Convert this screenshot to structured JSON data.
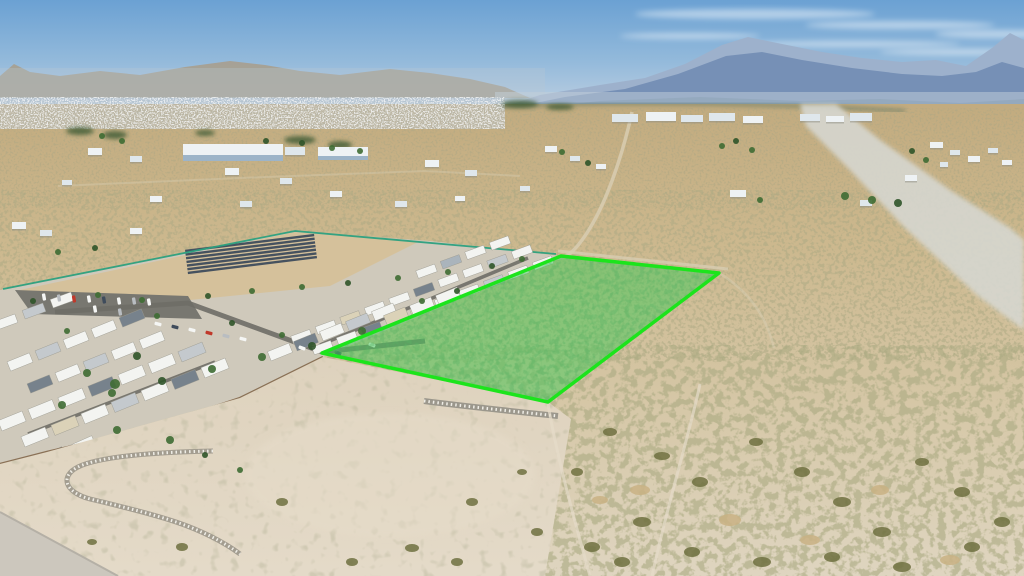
{
  "scene_meta": {
    "type": "aerial-drone-photo",
    "description": "Aerial photo of a desert valley: a vacant land parcel outlined and shaded in bright green, bordered by a mobile home park on the left, open desert scrub on the right, distant town and blue mountain ranges at the horizon."
  },
  "colors": {
    "sky_top": "#6ba1d3",
    "sky_mid": "#94badb",
    "sky_low": "#b5cbe0",
    "sky_horizon": "#ccd9e4",
    "cloud": "#ffffff",
    "left_hills": "#a79e8e",
    "haze_left": "#b9c6d2",
    "mtn_far": "#9db1cc",
    "mtn_main": "#7690b6",
    "mtn_foot": "#62809f",
    "haze_right": "#c3d0da",
    "valley_green": "#56715f",
    "desert_far": "#c2ab7f",
    "desert_mid": "#ccb88e",
    "desert_near": "#d7c9aa",
    "desert_bottom": "#dfd5c0",
    "wash": "#d7d8d2",
    "town_base": "#b6bfc6",
    "road_dirt": "#d8cdb2",
    "bldg_A": "#eef2f4",
    "bldg_B": "#dfe7ec",
    "bldg_C": "#9db4c8",
    "bldg_shadow": "#8d8d84",
    "park_base": "#cfc9bb",
    "dirt_lot": "#d5c19b",
    "parking": "#787770",
    "park_road": "#6f6e67",
    "solar": "#46525f",
    "fence_teal": "#2ba07e",
    "wall_brown": "#8a7156",
    "home_w": "#f3f4f1",
    "home_g": "#c4c9cd",
    "home_d": "#77828c",
    "home_t": "#dbd2b8",
    "home_b": "#aab4bc",
    "car_w": "#f5f6f4",
    "car_s": "#b9bdc1",
    "car_r": "#c0392b",
    "car_d": "#3f4c5c",
    "tree": "#3e6b33",
    "tree_dark": "#2f5429",
    "grove": "#3f5a33",
    "pad_light": "#e6dcc9",
    "pad_base1": "#ded2bd",
    "pad_base2": "#e4dac8",
    "berm": "#a39d90",
    "berm_rocks": "#efede6",
    "rock_strip": "#9b978c",
    "wedge": "#ccc7bd",
    "wedge_edge": "#b5b0a6",
    "shrub": "#6f7040",
    "grass": "#c9b184",
    "parcel_fill": "#46c95a",
    "parcel_stroke": "#1ce41c"
  },
  "parcel": {
    "points": "561,256 719,273 548,402 322,353"
  },
  "paths": {
    "left_hills": "M0,98 L0,76 L14,64 L30,72 L60,76 L100,71 L140,75 L185,67 L230,61 L265,65 L300,71 L340,75 L390,69 L430,73 L470,79 L505,87 L530,98 Z",
    "mtn_far": "M500,108 L540,95 L600,85 L645,78 L685,64 L722,45 L748,37 L782,44 L822,52 L862,58 L902,62 L936,60 L966,66 L992,48 L1010,33 L1024,40 L1024,108 Z",
    "mtn_main": "M510,108 L565,97 L625,89 L678,74 L726,56 L762,52 L802,60 L852,68 L902,74 L942,76 L976,72 L1002,62 L1024,68 L1024,108 Z",
    "mtn_foot": "M495,112 L600,101 L700,97 L800,101 L880,99 L960,103 L1024,99 L1024,120 L495,120 Z",
    "valley_green": "M495,106 Q700,99 905,111",
    "wash": "M800,104 L836,104 L880,140 L950,190 L1010,228 L1024,240 L1024,330 L978,296 L905,228 L848,168 L806,126 Z",
    "road_main": "M632,112 C622,158 606,202 590,228 C578,248 566,260 556,258",
    "road_ne": "M558,251 L728,269",
    "road_corner": "M719,273 C747,290 766,314 774,348",
    "road_left": "M58,186 L240,178 L425,171 L520,176",
    "fence_teal": "M3,289 L295,231 L556,254",
    "wall": "M323,357 L240,398 L150,428 L47,452 L0,464",
    "park_base": "M0,290 L295,231 L430,241 L561,256 L323,357 L240,398 L47,452 L0,464 Z",
    "dirt_lot": "M15,291 L295,232 L420,241 L330,286 L160,303 Z",
    "parking": "M15,290 L188,296 L202,319 L32,314 Z",
    "street1": "M55,312 L188,303 L322,352 L425,341",
    "street2": "M528,258 L320,345",
    "street3": "M215,362 L28,434",
    "pad": "M0,464 L47,452 L240,398 L323,357 L548,402 L571,419 L545,576 L0,576 Z",
    "rock_loop": "M213,451 C160,452 100,456 78,467 C60,476 64,492 90,499 C124,507 152,514 176,522 C200,530 224,542 240,554",
    "rock_strip": "M424,401 C462,406 510,411 558,416",
    "track1": "M700,384 C690,432 668,502 652,576",
    "track2": "M548,404 C556,452 572,512 590,576",
    "wedge": "M0,512 L118,576 L0,576 Z",
    "wedge_edge": "M0,512 L118,576"
  },
  "solar_array": {
    "x0": 186,
    "x1": 316,
    "y": 243,
    "dy": 3.7,
    "n": 7,
    "rot": -7,
    "cx": 250,
    "cy": 254
  },
  "scene": {
    "clouds": [
      [
        755,
        14,
        120,
        5
      ],
      [
        900,
        25,
        95,
        4
      ],
      [
        1000,
        34,
        65,
        4
      ],
      [
        690,
        36,
        70,
        3
      ],
      [
        850,
        44,
        110,
        3
      ],
      [
        960,
        52,
        80,
        3
      ]
    ],
    "buildings": [
      [
        183,
        144,
        100,
        12,
        "A"
      ],
      [
        183,
        155,
        100,
        6,
        "C"
      ],
      [
        285,
        147,
        20,
        8,
        "B"
      ],
      [
        318,
        147,
        50,
        10,
        "A"
      ],
      [
        318,
        156,
        50,
        4,
        "C"
      ],
      [
        612,
        114,
        26,
        8,
        "B"
      ],
      [
        646,
        112,
        30,
        9,
        "A"
      ],
      [
        681,
        115,
        22,
        7,
        "B"
      ],
      [
        709,
        113,
        26,
        8,
        "B"
      ],
      [
        743,
        116,
        20,
        7,
        "A"
      ],
      [
        800,
        114,
        20,
        7,
        "B"
      ],
      [
        826,
        116,
        18,
        6,
        "A"
      ],
      [
        850,
        113,
        22,
        8,
        "B"
      ],
      [
        930,
        142,
        13,
        6,
        "A"
      ],
      [
        950,
        150,
        10,
        5,
        "B"
      ],
      [
        968,
        156,
        12,
        6,
        "A"
      ],
      [
        988,
        148,
        10,
        5,
        "B"
      ],
      [
        1002,
        160,
        10,
        5,
        "A"
      ],
      [
        940,
        162,
        8,
        5,
        "B"
      ],
      [
        88,
        148,
        14,
        7,
        "A"
      ],
      [
        130,
        156,
        12,
        6,
        "B"
      ],
      [
        225,
        168,
        14,
        7,
        "A"
      ],
      [
        280,
        178,
        12,
        6,
        "B"
      ],
      [
        425,
        160,
        14,
        7,
        "A"
      ],
      [
        465,
        170,
        12,
        6,
        "B"
      ],
      [
        545,
        146,
        12,
        6,
        "A"
      ],
      [
        570,
        156,
        10,
        5,
        "B"
      ],
      [
        596,
        164,
        10,
        5,
        "A"
      ],
      [
        62,
        180,
        10,
        5,
        "B"
      ],
      [
        150,
        196,
        12,
        6,
        "A"
      ],
      [
        240,
        201,
        12,
        6,
        "B"
      ],
      [
        330,
        191,
        12,
        6,
        "A"
      ],
      [
        395,
        201,
        12,
        6,
        "B"
      ],
      [
        455,
        196,
        10,
        5,
        "A"
      ],
      [
        520,
        186,
        10,
        5,
        "B"
      ],
      [
        12,
        222,
        14,
        7,
        "A"
      ],
      [
        40,
        230,
        12,
        6,
        "B"
      ],
      [
        130,
        228,
        12,
        6,
        "A"
      ],
      [
        730,
        190,
        16,
        7,
        "A"
      ],
      [
        860,
        200,
        12,
        6,
        "B"
      ],
      [
        905,
        175,
        12,
        6,
        "A"
      ]
    ],
    "homes_rows": [
      {
        "x": 543,
        "y": 263,
        "n": 10,
        "dx": -24.5,
        "dy": 9.4,
        "w": 20,
        "h": 8,
        "r": -20,
        "cs": "wwgwwtwdww"
      },
      {
        "x": 522,
        "y": 252,
        "n": 10,
        "dx": -24.5,
        "dy": 9.4,
        "w": 20,
        "h": 8,
        "r": -20,
        "cs": "wgwwdwwtww"
      },
      {
        "x": 500,
        "y": 243,
        "n": 4,
        "dx": -24.5,
        "dy": 9.4,
        "w": 20,
        "h": 8,
        "r": -20,
        "cs": "wwbw"
      },
      {
        "x": 384,
        "y": 312,
        "n": 5,
        "dx": -26,
        "dy": 10,
        "w": 23,
        "h": 10,
        "r": -22,
        "cs": "wgwdw"
      },
      {
        "x": 448,
        "y": 296,
        "n": 3,
        "dx": -26,
        "dy": 10,
        "w": 23,
        "h": 10,
        "r": -22,
        "cs": "wwt"
      },
      {
        "x": 215,
        "y": 368,
        "n": 7,
        "dx": -30,
        "dy": 11.5,
        "w": 26,
        "h": 11,
        "r": -22,
        "cs": "wdwgwtw"
      },
      {
        "x": 192,
        "y": 352,
        "n": 7,
        "dx": -30,
        "dy": 11.5,
        "w": 26,
        "h": 11,
        "r": -22,
        "cs": "gwwdwww"
      },
      {
        "x": 152,
        "y": 340,
        "n": 5,
        "dx": -28,
        "dy": 11,
        "w": 24,
        "h": 10,
        "r": -22,
        "cs": "wwgwd"
      },
      {
        "x": 132,
        "y": 318,
        "n": 5,
        "dx": -28,
        "dy": 11,
        "w": 24,
        "h": 10,
        "r": -22,
        "cs": "dwwgw"
      },
      {
        "x": 62,
        "y": 300,
        "n": 3,
        "dx": -28,
        "dy": 11,
        "w": 22,
        "h": 9,
        "r": -20,
        "cs": "wgw"
      },
      {
        "x": 82,
        "y": 446,
        "n": 3,
        "dx": -30,
        "dy": 11,
        "w": 26,
        "h": 11,
        "r": -24,
        "cs": "wdw"
      }
    ],
    "cars": [
      [
        44,
        297,
        80,
        "w"
      ],
      [
        59,
        298,
        80,
        "s"
      ],
      [
        74,
        299,
        80,
        "r"
      ],
      [
        89,
        299,
        80,
        "w"
      ],
      [
        104,
        300,
        80,
        "d"
      ],
      [
        119,
        301,
        80,
        "w"
      ],
      [
        134,
        301,
        80,
        "s"
      ],
      [
        149,
        302,
        80,
        "w"
      ],
      [
        158,
        324,
        15,
        "w"
      ],
      [
        175,
        327,
        15,
        "d"
      ],
      [
        192,
        330,
        15,
        "w"
      ],
      [
        209,
        333,
        15,
        "r"
      ],
      [
        226,
        336,
        15,
        "s"
      ],
      [
        243,
        339,
        15,
        "w"
      ],
      [
        95,
        309,
        80,
        "w"
      ],
      [
        120,
        312,
        80,
        "s"
      ],
      [
        302,
        348,
        20,
        "w"
      ],
      [
        338,
        353,
        20,
        "d"
      ],
      [
        372,
        345,
        20,
        "w"
      ]
    ],
    "trees": [
      [
        736,
        141,
        3
      ],
      [
        722,
        146,
        3
      ],
      [
        752,
        150,
        3
      ],
      [
        912,
        151,
        3
      ],
      [
        926,
        160,
        3
      ],
      [
        562,
        152,
        3
      ],
      [
        588,
        163,
        3
      ],
      [
        102,
        136,
        3
      ],
      [
        122,
        141,
        3
      ],
      [
        302,
        143,
        3
      ],
      [
        332,
        148,
        3
      ],
      [
        360,
        151,
        3
      ],
      [
        266,
        141,
        3
      ],
      [
        845,
        196,
        4
      ],
      [
        872,
        200,
        4
      ],
      [
        898,
        203,
        4
      ],
      [
        760,
        200,
        3
      ],
      [
        58,
        252,
        3
      ],
      [
        95,
        248,
        3
      ],
      [
        98,
        295,
        3
      ],
      [
        142,
        300,
        3
      ],
      [
        208,
        296,
        3
      ],
      [
        252,
        291,
        3
      ],
      [
        302,
        287,
        3
      ],
      [
        348,
        283,
        3
      ],
      [
        398,
        278,
        3
      ],
      [
        448,
        272,
        3
      ],
      [
        492,
        266,
        3
      ],
      [
        522,
        259,
        3
      ],
      [
        362,
        331,
        4
      ],
      [
        312,
        346,
        4
      ],
      [
        262,
        357,
        4
      ],
      [
        212,
        369,
        4
      ],
      [
        162,
        381,
        4
      ],
      [
        112,
        393,
        4
      ],
      [
        62,
        405,
        4
      ],
      [
        33,
        301,
        3
      ],
      [
        67,
        331,
        3
      ],
      [
        157,
        316,
        3
      ],
      [
        232,
        323,
        3
      ],
      [
        282,
        335,
        3
      ],
      [
        422,
        301,
        3
      ],
      [
        457,
        291,
        3
      ],
      [
        117,
        430,
        4
      ],
      [
        87,
        373,
        4
      ],
      [
        137,
        356,
        4
      ],
      [
        115,
        384,
        5
      ],
      [
        170,
        440,
        4
      ],
      [
        205,
        455,
        3
      ],
      [
        240,
        470,
        3
      ]
    ],
    "groves": [
      [
        80,
        131,
        14,
        4
      ],
      [
        115,
        135,
        12,
        4
      ],
      [
        300,
        140,
        16,
        4
      ],
      [
        340,
        145,
        12,
        4
      ],
      [
        205,
        133,
        10,
        3
      ],
      [
        520,
        104,
        18,
        4
      ],
      [
        560,
        107,
        14,
        3
      ]
    ],
    "bushes": [
      [
        610,
        432,
        7,
        4,
        "o"
      ],
      [
        662,
        456,
        8,
        4,
        "o"
      ],
      [
        700,
        482,
        8,
        5,
        "o"
      ],
      [
        642,
        522,
        9,
        5,
        "o"
      ],
      [
        592,
        547,
        8,
        5,
        "o"
      ],
      [
        756,
        442,
        7,
        4,
        "o"
      ],
      [
        802,
        472,
        8,
        5,
        "o"
      ],
      [
        842,
        502,
        9,
        5,
        "o"
      ],
      [
        882,
        532,
        9,
        5,
        "o"
      ],
      [
        922,
        462,
        7,
        4,
        "o"
      ],
      [
        962,
        492,
        8,
        5,
        "o"
      ],
      [
        1002,
        522,
        8,
        5,
        "o"
      ],
      [
        762,
        562,
        9,
        5,
        "o"
      ],
      [
        832,
        557,
        8,
        5,
        "o"
      ],
      [
        902,
        567,
        9,
        5,
        "o"
      ],
      [
        972,
        547,
        8,
        5,
        "o"
      ],
      [
        577,
        472,
        6,
        4,
        "o"
      ],
      [
        622,
        562,
        8,
        5,
        "o"
      ],
      [
        412,
        548,
        7,
        4,
        "o"
      ],
      [
        352,
        562,
        6,
        4,
        "o"
      ],
      [
        282,
        502,
        6,
        4,
        "o"
      ],
      [
        182,
        547,
        6,
        4,
        "o"
      ],
      [
        92,
        542,
        5,
        3,
        "o"
      ],
      [
        472,
        502,
        6,
        4,
        "o"
      ],
      [
        522,
        472,
        5,
        3,
        "o"
      ],
      [
        692,
        552,
        8,
        5,
        "o"
      ],
      [
        537,
        532,
        6,
        4,
        "o"
      ],
      [
        457,
        562,
        6,
        4,
        "o"
      ],
      [
        640,
        490,
        10,
        5,
        "t"
      ],
      [
        730,
        520,
        11,
        6,
        "t"
      ],
      [
        810,
        540,
        10,
        5,
        "t"
      ],
      [
        880,
        490,
        9,
        5,
        "t"
      ],
      [
        950,
        560,
        10,
        5,
        "t"
      ],
      [
        600,
        500,
        8,
        4,
        "t"
      ]
    ]
  }
}
